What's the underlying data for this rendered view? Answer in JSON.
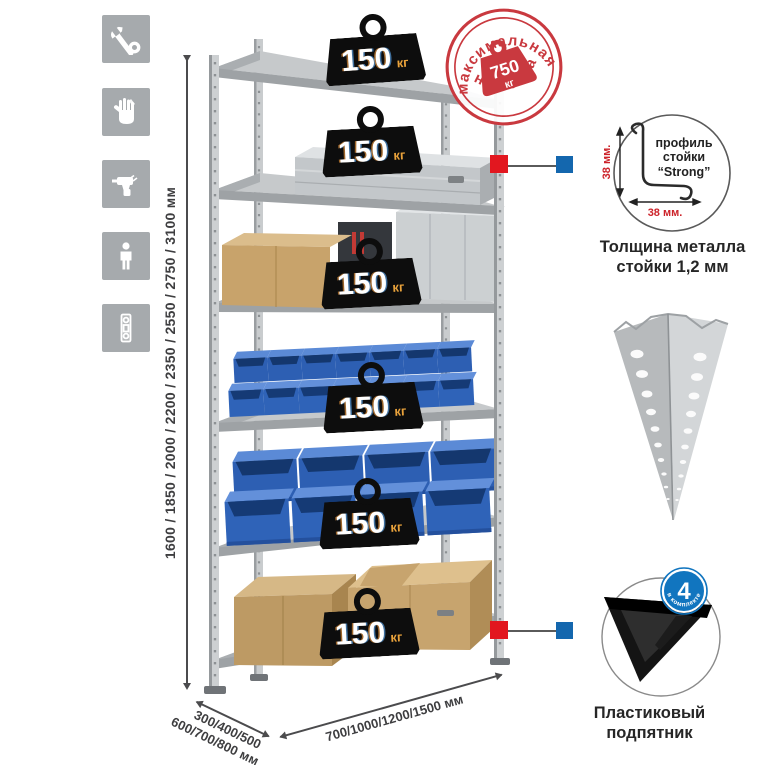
{
  "sidebar": {
    "items": [
      {
        "icon": "wrench-icon"
      },
      {
        "icon": "gloves-icon"
      },
      {
        "icon": "drill-icon"
      },
      {
        "icon": "person-icon"
      },
      {
        "icon": "level-icon"
      }
    ]
  },
  "dimensions": {
    "height_label": "1600 / 1850 / 2000 / 2200 / 2350 / 2550 / 2750 / 3100 мм",
    "depth_line1": "300/400/500",
    "depth_line2": "600/700/800 мм",
    "width_label": "700/1000/1200/1500 мм"
  },
  "stamp": {
    "arc_top": "максимальная",
    "arc_bottom": "нагрузка",
    "value": "750",
    "unit": "кг"
  },
  "shelf_loads": [
    {
      "value": "150",
      "unit": "кг"
    },
    {
      "value": "150",
      "unit": "кг"
    },
    {
      "value": "150",
      "unit": "кг"
    },
    {
      "value": "150",
      "unit": "кг"
    },
    {
      "value": "150",
      "unit": "кг"
    },
    {
      "value": "150",
      "unit": "кг"
    }
  ],
  "profile_detail": {
    "label_line1": "профиль",
    "label_line2": "стойки",
    "label_line3": "“Strong”",
    "vertical_dim": "38 мм.",
    "horizontal_dim": "38 мм.",
    "caption_line1": "Толщина металла",
    "caption_line2": "стойки 1,2 мм"
  },
  "foot_detail": {
    "count": "4",
    "arc_text": "в комплекте",
    "caption_line1": "Пластиковый",
    "caption_line2": "подпятник"
  },
  "colors": {
    "accent_red": "#e2171f",
    "accent_blue": "#1467ae",
    "stamp_red": "#c9393f",
    "bin_blue": "#2f63b8",
    "badge_orange": "#e9a23b"
  }
}
